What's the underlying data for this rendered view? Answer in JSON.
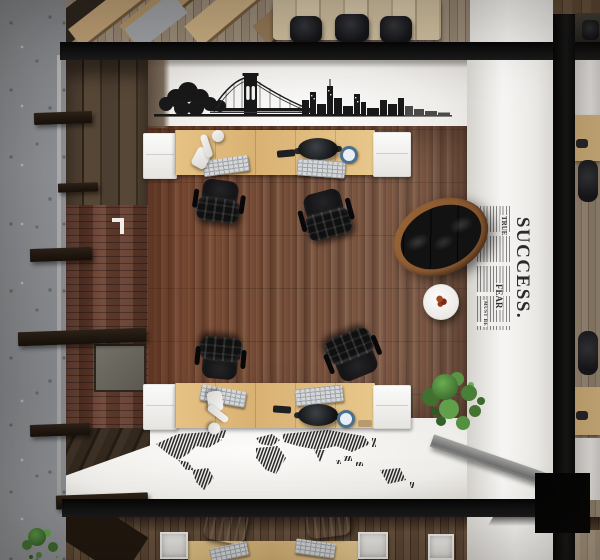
{
  "scene": {
    "title": "top-down-loft-office-render",
    "description": "Bird's-eye 3D render of a loft office room framed by black steel beams: wood plank floor, two facing desk rows with workstations, four black leather office chairs, oval wood-rim leather sofa, round white side table, green plant, concrete surroundings and neighbouring offices"
  },
  "wall_art": {
    "success_poster": {
      "headline": "SUCCESS.",
      "word_true": "TRUE",
      "word_fear": "FEAR",
      "word_must_be": "MUST BE"
    },
    "bridge_decal": "brooklyn-bridge-and-skyline-silhouette",
    "map_decal": "barcode-world-map"
  },
  "objects": {
    "main_room_desks": 2,
    "main_room_chairs": 4,
    "conference_chairs": 3,
    "sofa": 1,
    "side_table": 1,
    "plants": 2,
    "keyboards": 6,
    "monitors": 2,
    "desk_lamps": 2,
    "mugs": 2
  },
  "colors": {
    "beam_black": "#0a0a0a",
    "concrete_gray": "#8b8e92",
    "wall_white": "#f5f4f2",
    "floor_wood": "#6f4c38",
    "desk_wood": "#dcbc81",
    "brick_wall": "#6b4232",
    "leather_black": "#141414",
    "sofa_rim": "#8a5731",
    "plant_green": "#4a7f37",
    "mug_blue": "#49708f"
  }
}
